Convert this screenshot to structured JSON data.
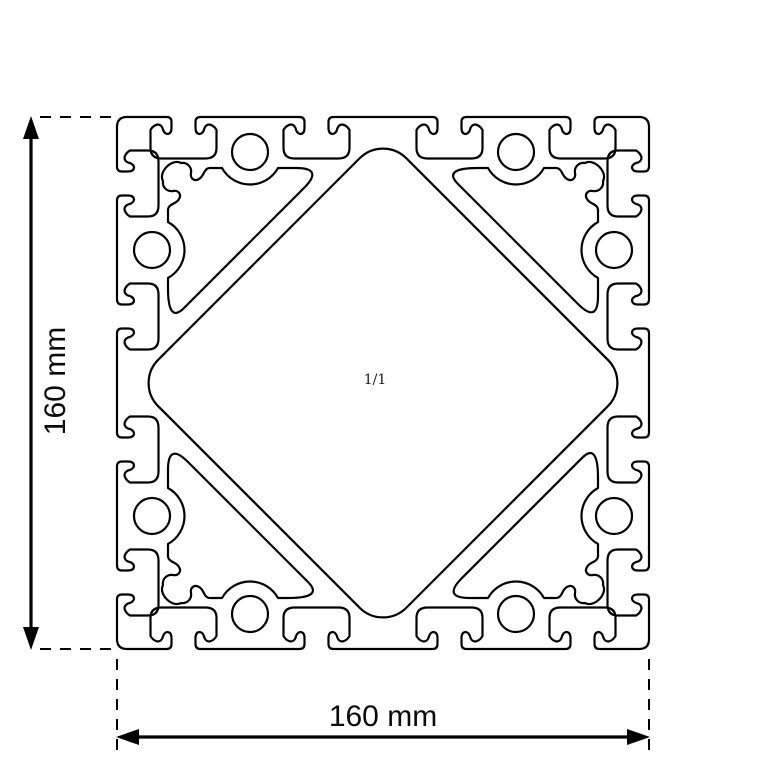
{
  "drawing": {
    "kind": "aluminium-extrusion-profile-cross-section",
    "scale_label": "1/1",
    "dim_height": {
      "label": "160 mm",
      "value": 160,
      "unit": "mm"
    },
    "dim_width": {
      "label": "160 mm",
      "value": 160,
      "unit": "mm"
    },
    "colors": {
      "line": "#000000",
      "background": "#ffffff"
    }
  }
}
